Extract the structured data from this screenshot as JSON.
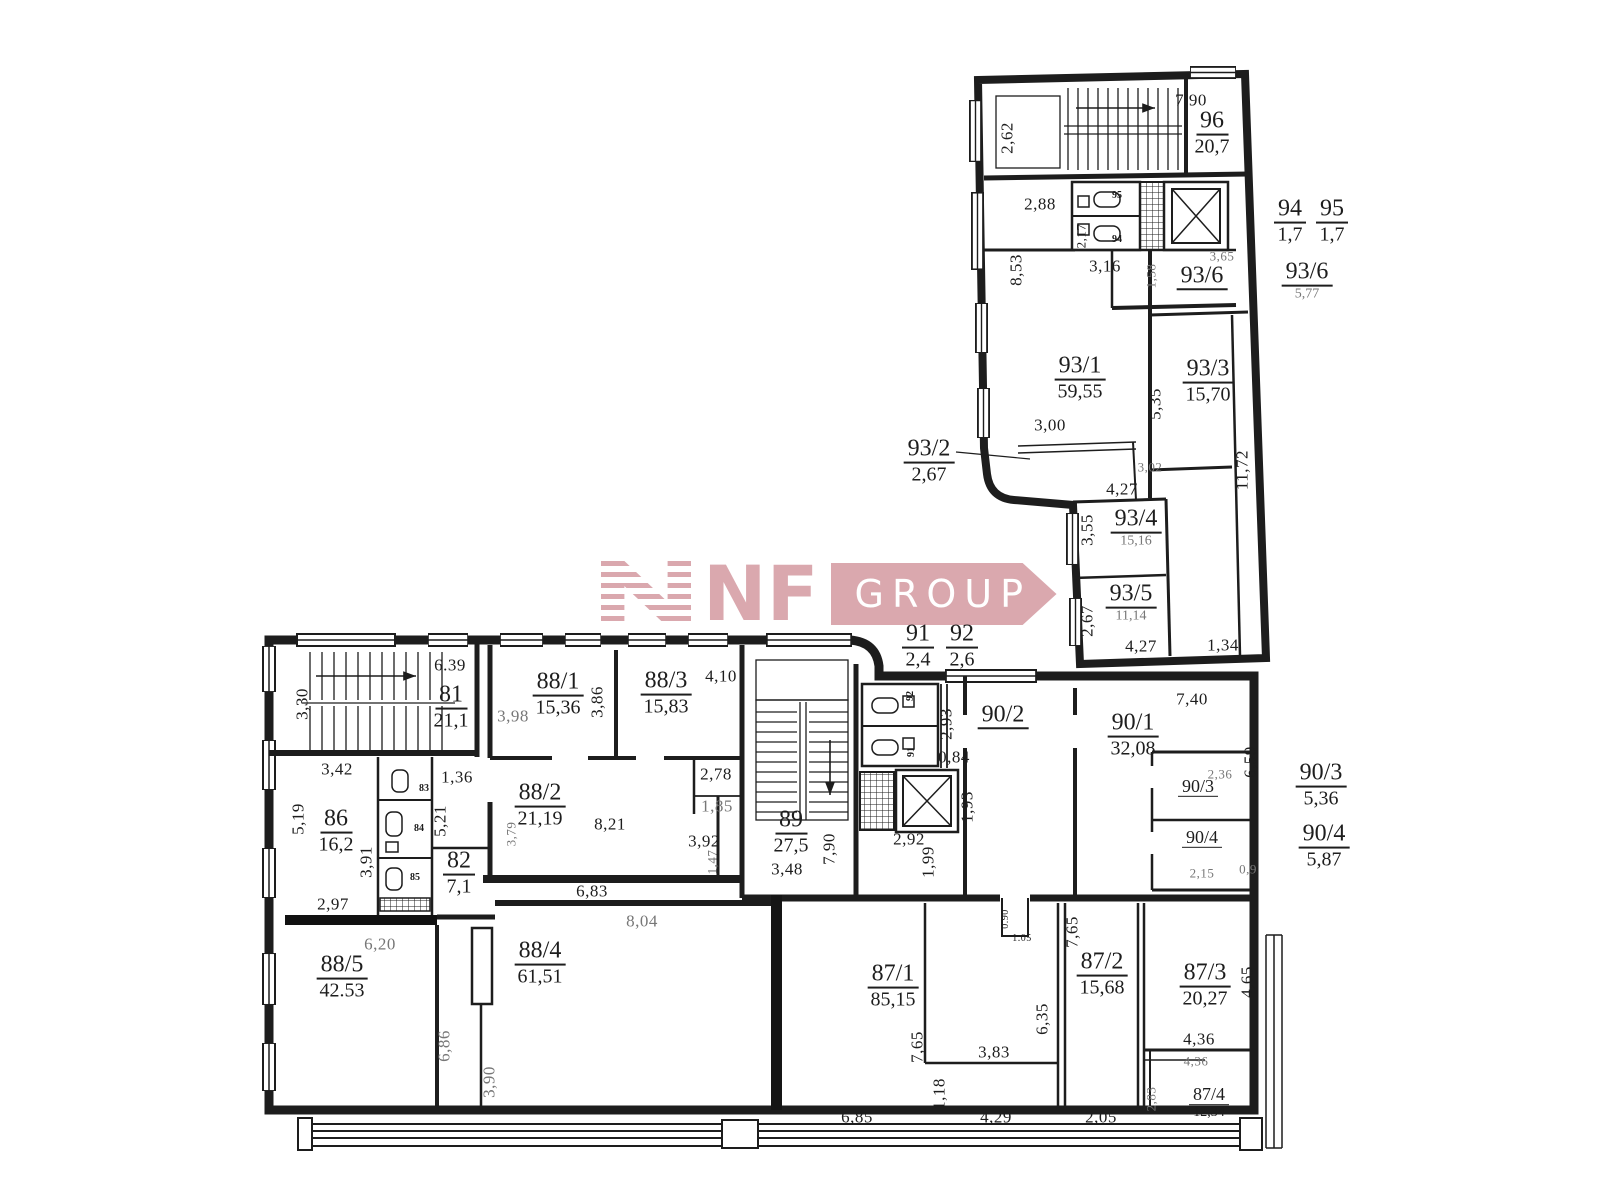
{
  "logo": {
    "nf": "NF",
    "group": "GROUP",
    "color": "#d7a1a8"
  },
  "rooms": [
    {
      "id": "96",
      "area": "20,7",
      "x": 1212,
      "y": 133
    },
    {
      "id": "94",
      "area": "1,7",
      "x": 1290,
      "y": 221
    },
    {
      "id": "95",
      "area": "1,7",
      "x": 1332,
      "y": 221
    },
    {
      "id": "93/6",
      "area": null,
      "x": 1202,
      "y": 277
    },
    {
      "id": "93/6",
      "area": "5,77",
      "x": 1307,
      "y": 281,
      "am": true
    },
    {
      "id": "93/1",
      "area": "59,55",
      "x": 1080,
      "y": 378
    },
    {
      "id": "93/3",
      "area": "15,70",
      "x": 1208,
      "y": 381
    },
    {
      "id": "93/2",
      "area": "2,67",
      "x": 929,
      "y": 461
    },
    {
      "id": "93/4",
      "area": "15,16",
      "x": 1136,
      "y": 528,
      "am": true
    },
    {
      "id": "93/5",
      "area": "11,14",
      "x": 1131,
      "y": 603,
      "am": true
    },
    {
      "id": "91",
      "area": "2,4",
      "x": 918,
      "y": 646
    },
    {
      "id": "92",
      "area": "2,6",
      "x": 962,
      "y": 646
    },
    {
      "id": "81",
      "area": "21,1",
      "x": 451,
      "y": 707
    },
    {
      "id": "88/1",
      "area": "15,36",
      "x": 558,
      "y": 694
    },
    {
      "id": "88/3",
      "area": "15,83",
      "x": 666,
      "y": 693
    },
    {
      "id": "88/2",
      "area": "21,19",
      "x": 540,
      "y": 805
    },
    {
      "id": "86",
      "area": "16,2",
      "x": 336,
      "y": 831
    },
    {
      "id": "82",
      "area": "7,1",
      "x": 459,
      "y": 873
    },
    {
      "id": "89",
      "area": "27,5",
      "x": 791,
      "y": 832
    },
    {
      "id": "90/2",
      "area": null,
      "x": 1003,
      "y": 716
    },
    {
      "id": "90/1",
      "area": "32,08",
      "x": 1133,
      "y": 735
    },
    {
      "id": "90/3",
      "area": null,
      "x": 1198,
      "y": 787,
      "small": true
    },
    {
      "id": "90/4",
      "area": null,
      "x": 1202,
      "y": 838,
      "small": true
    },
    {
      "id": "90/3",
      "area": "5,36",
      "x": 1321,
      "y": 785
    },
    {
      "id": "90/4",
      "area": "5,87",
      "x": 1324,
      "y": 846
    },
    {
      "id": "88/5",
      "area": "42.53",
      "x": 342,
      "y": 977
    },
    {
      "id": "88/4",
      "area": "61,51",
      "x": 540,
      "y": 963
    },
    {
      "id": "87/1",
      "area": "85,15",
      "x": 893,
      "y": 986
    },
    {
      "id": "87/2",
      "area": "15,68",
      "x": 1102,
      "y": 974
    },
    {
      "id": "87/3",
      "area": "20,27",
      "x": 1205,
      "y": 985
    },
    {
      "id": "87/4",
      "area": "12,34",
      "x": 1209,
      "y": 1103,
      "small": true
    }
  ],
  "dims": [
    {
      "t": "7,90",
      "x": 1191,
      "y": 100
    },
    {
      "t": "2,62",
      "x": 1007,
      "y": 138,
      "v": true
    },
    {
      "t": "2,88",
      "x": 1040,
      "y": 204
    },
    {
      "t": "2,17",
      "x": 1081,
      "y": 236,
      "v": true,
      "s": true
    },
    {
      "t": "3,16",
      "x": 1105,
      "y": 266
    },
    {
      "t": "8,53",
      "x": 1016,
      "y": 270,
      "v": true
    },
    {
      "t": "3,65",
      "x": 1222,
      "y": 256,
      "s": true,
      "m": true
    },
    {
      "t": "1,58",
      "x": 1151,
      "y": 276,
      "v": true,
      "s": true,
      "m": true
    },
    {
      "t": "3,00",
      "x": 1050,
      "y": 425
    },
    {
      "t": "5,35",
      "x": 1155,
      "y": 404,
      "v": true
    },
    {
      "t": "3,02",
      "x": 1150,
      "y": 467,
      "s": true,
      "m": true
    },
    {
      "t": "4,27",
      "x": 1122,
      "y": 489
    },
    {
      "t": "11,72",
      "x": 1242,
      "y": 470,
      "v": true
    },
    {
      "t": "3,55",
      "x": 1087,
      "y": 530,
      "v": true
    },
    {
      "t": "2,67",
      "x": 1087,
      "y": 621,
      "v": true
    },
    {
      "t": "4,27",
      "x": 1141,
      "y": 646
    },
    {
      "t": "1,34",
      "x": 1223,
      "y": 645
    },
    {
      "t": "6.39",
      "x": 450,
      "y": 665
    },
    {
      "t": "3,30",
      "x": 302,
      "y": 704,
      "v": true
    },
    {
      "t": "3,42",
      "x": 337,
      "y": 769
    },
    {
      "t": "1,36",
      "x": 457,
      "y": 777
    },
    {
      "t": "3,98",
      "x": 513,
      "y": 716,
      "m": true
    },
    {
      "t": "3,86",
      "x": 597,
      "y": 702,
      "v": true
    },
    {
      "t": "4,10",
      "x": 721,
      "y": 676
    },
    {
      "t": "2,78",
      "x": 716,
      "y": 774
    },
    {
      "t": "1,85",
      "x": 717,
      "y": 806,
      "m": true
    },
    {
      "t": "5,19",
      "x": 298,
      "y": 819,
      "v": true
    },
    {
      "t": "5,21",
      "x": 440,
      "y": 821,
      "v": true
    },
    {
      "t": "3,91",
      "x": 366,
      "y": 862,
      "v": true
    },
    {
      "t": "8,21",
      "x": 610,
      "y": 824
    },
    {
      "t": "3,79",
      "x": 511,
      "y": 834,
      "v": true,
      "s": true,
      "m": true
    },
    {
      "t": "3,92",
      "x": 704,
      "y": 841
    },
    {
      "t": "1,47",
      "x": 712,
      "y": 862,
      "v": true,
      "s": true,
      "m": true
    },
    {
      "t": "2,97",
      "x": 333,
      "y": 904
    },
    {
      "t": "6,83",
      "x": 592,
      "y": 891
    },
    {
      "t": "3,48",
      "x": 787,
      "y": 869
    },
    {
      "t": "7,90",
      "x": 829,
      "y": 849,
      "v": true
    },
    {
      "t": "2,92",
      "x": 909,
      "y": 839
    },
    {
      "t": "1,99",
      "x": 928,
      "y": 862,
      "v": true
    },
    {
      "t": "2,93",
      "x": 946,
      "y": 724,
      "v": true
    },
    {
      "t": "0,84",
      "x": 954,
      "y": 757
    },
    {
      "t": "1,93",
      "x": 967,
      "y": 807,
      "v": true
    },
    {
      "t": "7,40",
      "x": 1192,
      "y": 699
    },
    {
      "t": "6,59",
      "x": 1250,
      "y": 762,
      "v": true
    },
    {
      "t": "2,36",
      "x": 1220,
      "y": 774,
      "s": true,
      "m": true
    },
    {
      "t": "2,15",
      "x": 1202,
      "y": 873,
      "s": true,
      "m": true
    },
    {
      "t": "0,9",
      "x": 1248,
      "y": 869,
      "s": true,
      "m": true
    },
    {
      "t": "6,20",
      "x": 380,
      "y": 944,
      "m": true
    },
    {
      "t": "8,04",
      "x": 642,
      "y": 921,
      "m": true
    },
    {
      "t": "6,86",
      "x": 444,
      "y": 1046,
      "v": true,
      "m": true
    },
    {
      "t": "3,90",
      "x": 489,
      "y": 1082,
      "v": true,
      "m": true
    },
    {
      "t": "6,85",
      "x": 857,
      "y": 1117
    },
    {
      "t": "7,65",
      "x": 917,
      "y": 1047,
      "v": true
    },
    {
      "t": "1,18",
      "x": 939,
      "y": 1094,
      "v": true
    },
    {
      "t": "3,83",
      "x": 994,
      "y": 1052
    },
    {
      "t": "4,29",
      "x": 996,
      "y": 1117
    },
    {
      "t": "6,35",
      "x": 1042,
      "y": 1019,
      "v": true
    },
    {
      "t": "7,65",
      "x": 1072,
      "y": 932,
      "v": true
    },
    {
      "t": "2,05",
      "x": 1101,
      "y": 1117
    },
    {
      "t": "4,65",
      "x": 1247,
      "y": 982,
      "v": true
    },
    {
      "t": "4,36",
      "x": 1199,
      "y": 1039
    },
    {
      "t": "4,36",
      "x": 1196,
      "y": 1061,
      "s": true,
      "m": true
    },
    {
      "t": "2,83",
      "x": 1151,
      "y": 1099,
      "v": true,
      "s": true,
      "m": true
    },
    {
      "t": "0.90",
      "x": 1006,
      "y": 919,
      "v": true,
      "tiny": true
    },
    {
      "t": "1.05",
      "x": 1022,
      "y": 939,
      "tiny": true
    }
  ],
  "fixture_ids": [
    {
      "t": "95",
      "x": 1117,
      "y": 196
    },
    {
      "t": "94",
      "x": 1117,
      "y": 240
    },
    {
      "t": "83",
      "x": 424,
      "y": 789
    },
    {
      "t": "84",
      "x": 419,
      "y": 829
    },
    {
      "t": "85",
      "x": 415,
      "y": 878
    },
    {
      "t": "92",
      "x": 911,
      "y": 696,
      "v": true
    },
    {
      "t": "91",
      "x": 912,
      "y": 752,
      "v": true
    }
  ]
}
